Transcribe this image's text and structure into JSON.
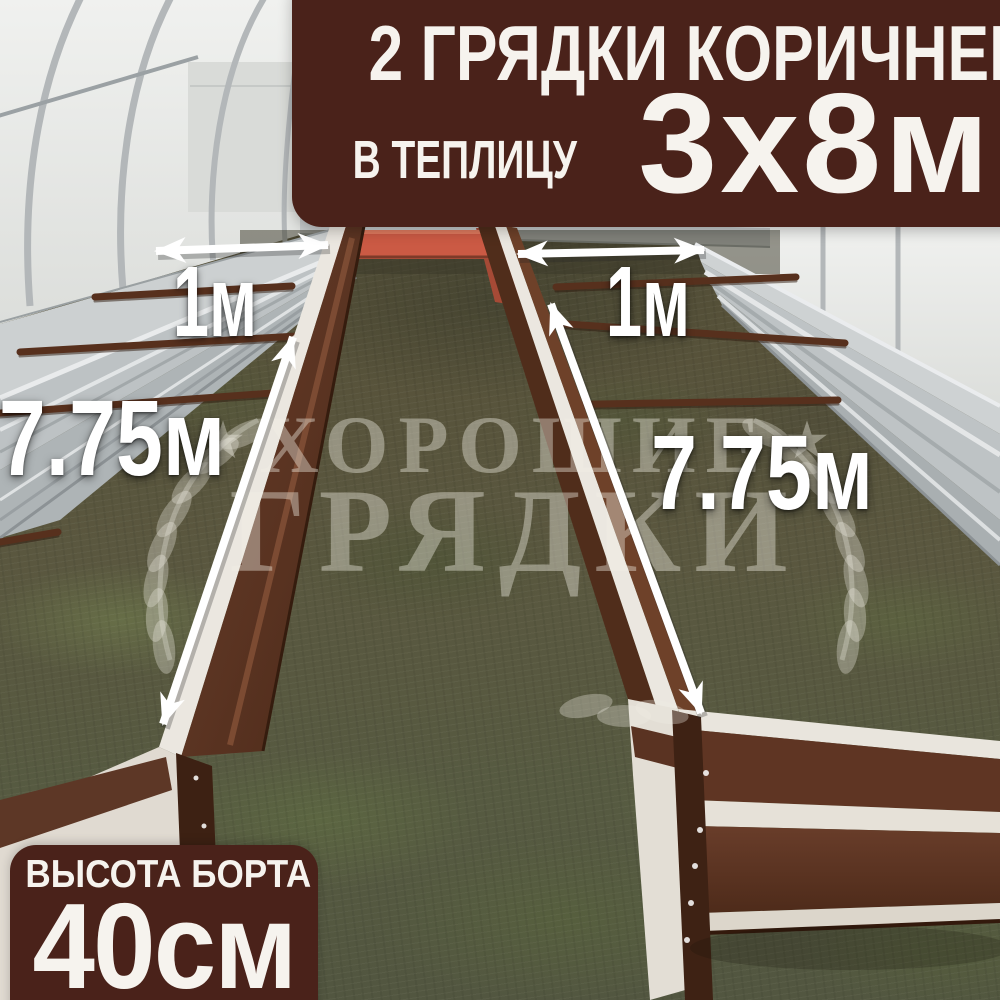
{
  "top_banner": {
    "line1": "2 ГРЯДКИ КОРИЧНЕВЫЕ",
    "line2_prefix": "В ТЕПЛИЦУ",
    "line2_size": "3х8м"
  },
  "bottom_banner": {
    "line1": "ВЫСОТА БОРТА",
    "line2": "40см"
  },
  "measurements": {
    "left_bed_width": "1м",
    "right_bed_width": "1м",
    "left_bed_length": "7.75м",
    "right_bed_length": "7.75м"
  },
  "watermark": {
    "star": "★",
    "line1": "ХОРОШИЕ",
    "line2": "ГРЯДКИ"
  },
  "colors": {
    "banner_bg": "#4a221a",
    "banner_text": "#f6f3ee",
    "label_text": "#ffffff",
    "arrow": "#ffffff",
    "watermark_text": "#f0ede4",
    "bed_brown": "#5c3424",
    "metal_silver": "#c6cacc",
    "orange_panel": "#cb5a44",
    "greenhouse_wall": "#e9eae8"
  }
}
